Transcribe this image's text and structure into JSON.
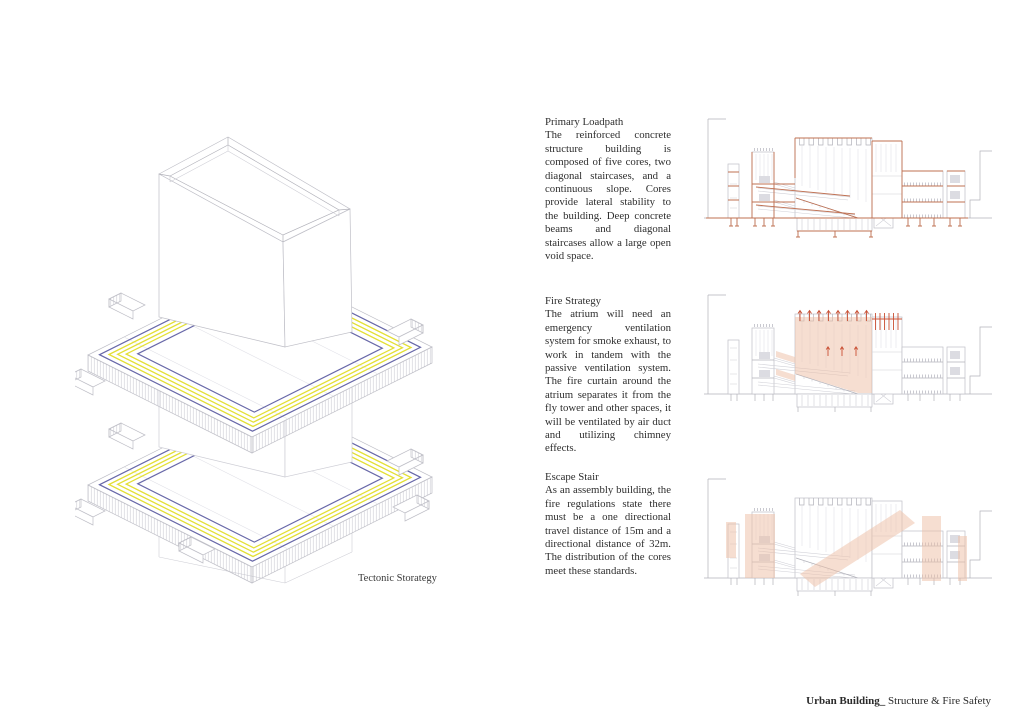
{
  "axon": {
    "caption": "Tectonic Storategy"
  },
  "annotations": [
    {
      "id": "primary-loadpath",
      "title": "Primary Loadpath",
      "body": "The reinforced concrete structure building is composed of five cores, two diagonal staircases, and a continuous slope. Cores provide lateral stability to the building. Deep concrete beams and diagonal staircases allow a large open void space."
    },
    {
      "id": "fire-strategy",
      "title": "Fire Strategy",
      "body": "The atrium will need an emergency ventilation system for smoke exhaust, to work in tandem with the passive ventilation system.  The fire curtain around the atrium separates it from the fly tower and other spaces, it will be ventilated  by air duct and utilizing chimney effects."
    },
    {
      "id": "escape-stair",
      "title": "Escape Stair",
      "body": "As an assembly building, the fire regulations state there must be a one directional travel distance of 15m and a directional distance of 32m. The distribution of the cores meet these standards."
    }
  ],
  "footer": {
    "project": "Urban Building_",
    "section": " Structure & Fire Safety"
  },
  "colors": {
    "structure_orange": "#bf7052",
    "highlight_salmon": "#eebda4",
    "arrow_red": "#c94f33",
    "drawing_gray": "#b2b2ba",
    "rebar_yellow": "#e3df35",
    "edge_blue": "#6868a8"
  }
}
